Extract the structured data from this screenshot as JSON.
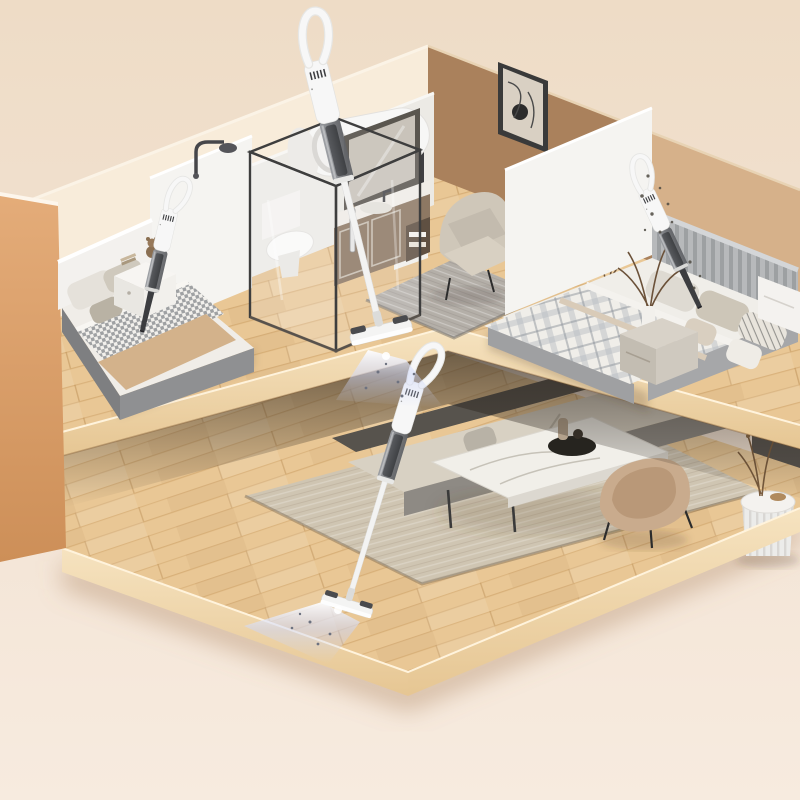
{
  "scene": {
    "title": "Isometric cutaway render of a two-level home; four cordless stick/handheld vacuums cleaning beds and wood floors with blue suction light beams",
    "type": "3d-product-render",
    "levels": [
      {
        "name": "upper-level",
        "rooms": [
          "left-bedroom",
          "bathroom",
          "reading-nook",
          "right-bedroom"
        ]
      },
      {
        "name": "lower-level",
        "rooms": [
          "living-room"
        ]
      }
    ],
    "products": [
      {
        "id": "handheld-vacuum-left-bed",
        "form": "handheld with crevice nozzle",
        "location": "left bedroom, cleaning mattress"
      },
      {
        "id": "stick-vacuum-upper-floor",
        "form": "stick with floor head",
        "location": "upper hallway floor, beam on"
      },
      {
        "id": "handheld-vacuum-right-bed",
        "form": "handheld with crevice nozzle",
        "location": "right bedroom, cleaning mattress, dust particles visible"
      },
      {
        "id": "stick-vacuum-lower-floor",
        "form": "stick with floor head",
        "location": "living room wood floor, beam on"
      }
    ],
    "furniture": [
      "bed",
      "nightstand",
      "teddy-bear",
      "shower-enclosure",
      "toilet",
      "water-heater",
      "vanity-mirror",
      "armchair",
      "wall-art",
      "side-table",
      "rug",
      "sofa",
      "coffee-table",
      "accent-chair",
      "fluted-side-table",
      "tv-console"
    ]
  },
  "colors": {
    "bg_top": "#eedcc6",
    "bg_mid": "#f2e2d2",
    "bg_bottom": "#f7ebdf",
    "wall_cream": "#f8ecda",
    "wall_white": "#f5f4f1",
    "wall_white_shade": "#e9e7e2",
    "wall_tan": "#e0a873",
    "wall_tan_dark": "#cd8f58",
    "wall_caramel": "#aa815c",
    "wall_caramel_light": "#d6b18a",
    "wall_dark": "#57534e",
    "wood": "#e9c795",
    "wood_side": "#f2ddb6",
    "rug_gray": "#b4afa8",
    "rug_beige": "#cfc5b2",
    "sofa_beige": "#d8d1c3",
    "sofa_base": "#8e8a84",
    "sofa_dark": "#57534d",
    "chair_tan": "#c9ab8d",
    "marble": "#f1efe9",
    "cabinet_brown": "#8d7863",
    "bed_gray": "#8f9092",
    "duvet_tan": "#d3b28b",
    "headboard_gray": "#b7b9bb",
    "vac_white": "#f7f7f7",
    "vac_gray": "#6f7174",
    "vac_dark": "#3c3d40",
    "beam_blue": "#ccd6fa",
    "shadow_warm": "#a9805b"
  }
}
